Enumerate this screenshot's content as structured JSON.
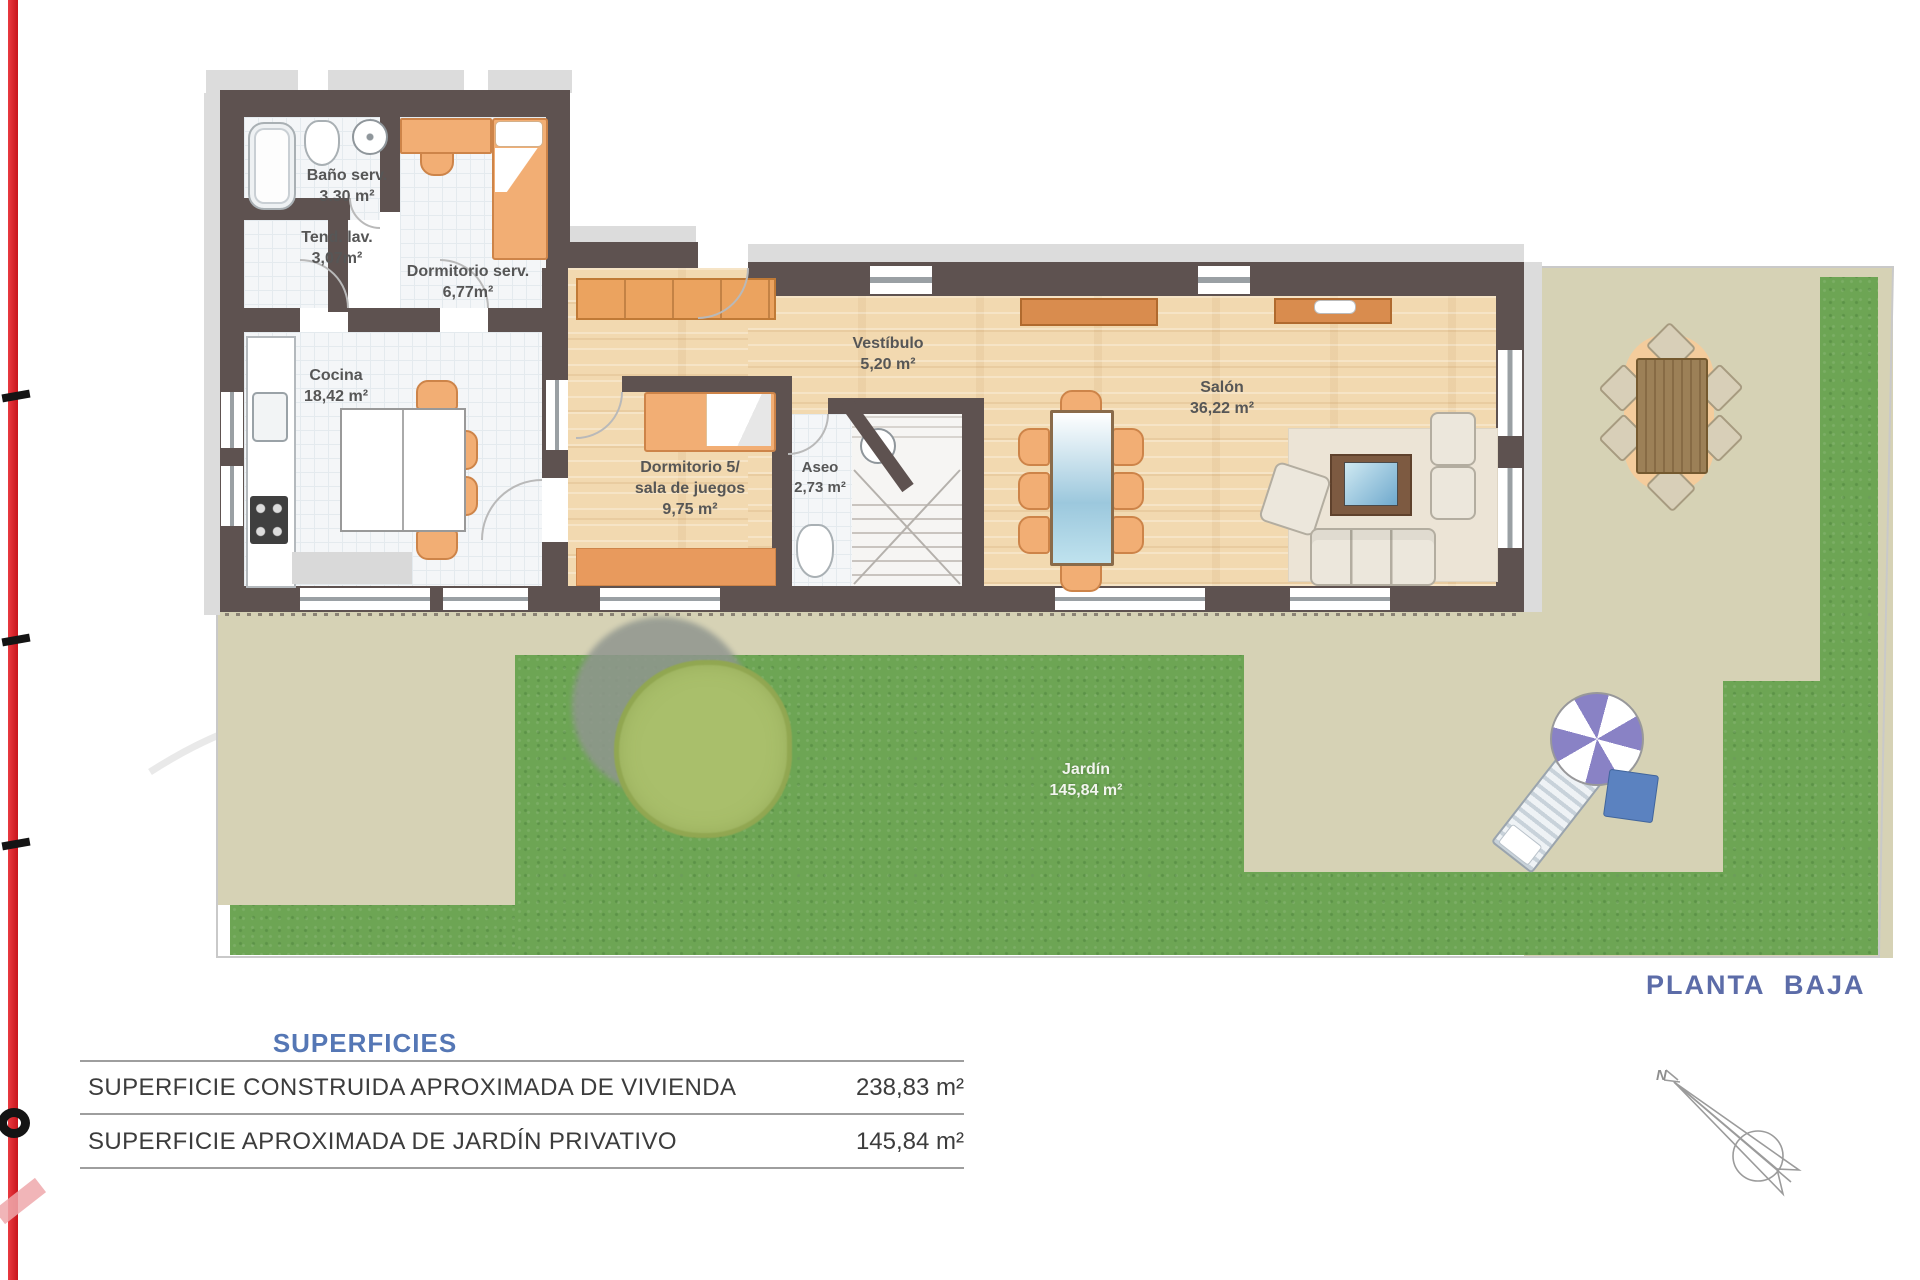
{
  "plan": {
    "title": "PLANTA BAJA",
    "compass_label": "N",
    "rooms": {
      "bano": {
        "name": "Baño serv.",
        "area": "3.30 m²"
      },
      "tendedero": {
        "name": "Tend. lav.",
        "area": "3,07m²"
      },
      "dorm_serv": {
        "name": "Dormitorio serv.",
        "area": "6,77m²"
      },
      "cocina": {
        "name": "Cocina",
        "area": "18,42 m²"
      },
      "dormitorio5": {
        "line1": "Dormitorio 5/",
        "line2": "sala de juegos",
        "area": "9,75 m²"
      },
      "vestibulo": {
        "name": "Vestíbulo",
        "area": "5,20 m²"
      },
      "aseo": {
        "name": "Aseo",
        "area": "2,73 m²"
      },
      "salon": {
        "name": "Salón",
        "area": "36,22 m²"
      },
      "jardin": {
        "name": "Jardín",
        "area": "145,84 m²"
      }
    }
  },
  "superficies": {
    "header": "SUPERFICIES",
    "rows": [
      {
        "label": "SUPERFICIE CONSTRUIDA APROXIMADA DE VIVIENDA",
        "value": "238,83 m²"
      },
      {
        "label": "SUPERFICIE APROXIMADA DE JARDÍN PRIVATIVO",
        "value": "145,84 m²"
      }
    ]
  },
  "colors": {
    "accent_red": "#d8232a",
    "wall": "#5e5250",
    "wood_floor": "#f2d9b0",
    "grass": "#6da554",
    "terrace": "#d6d2b5",
    "title_blue": "#5c6ca8",
    "header_blue": "#5577b5"
  }
}
